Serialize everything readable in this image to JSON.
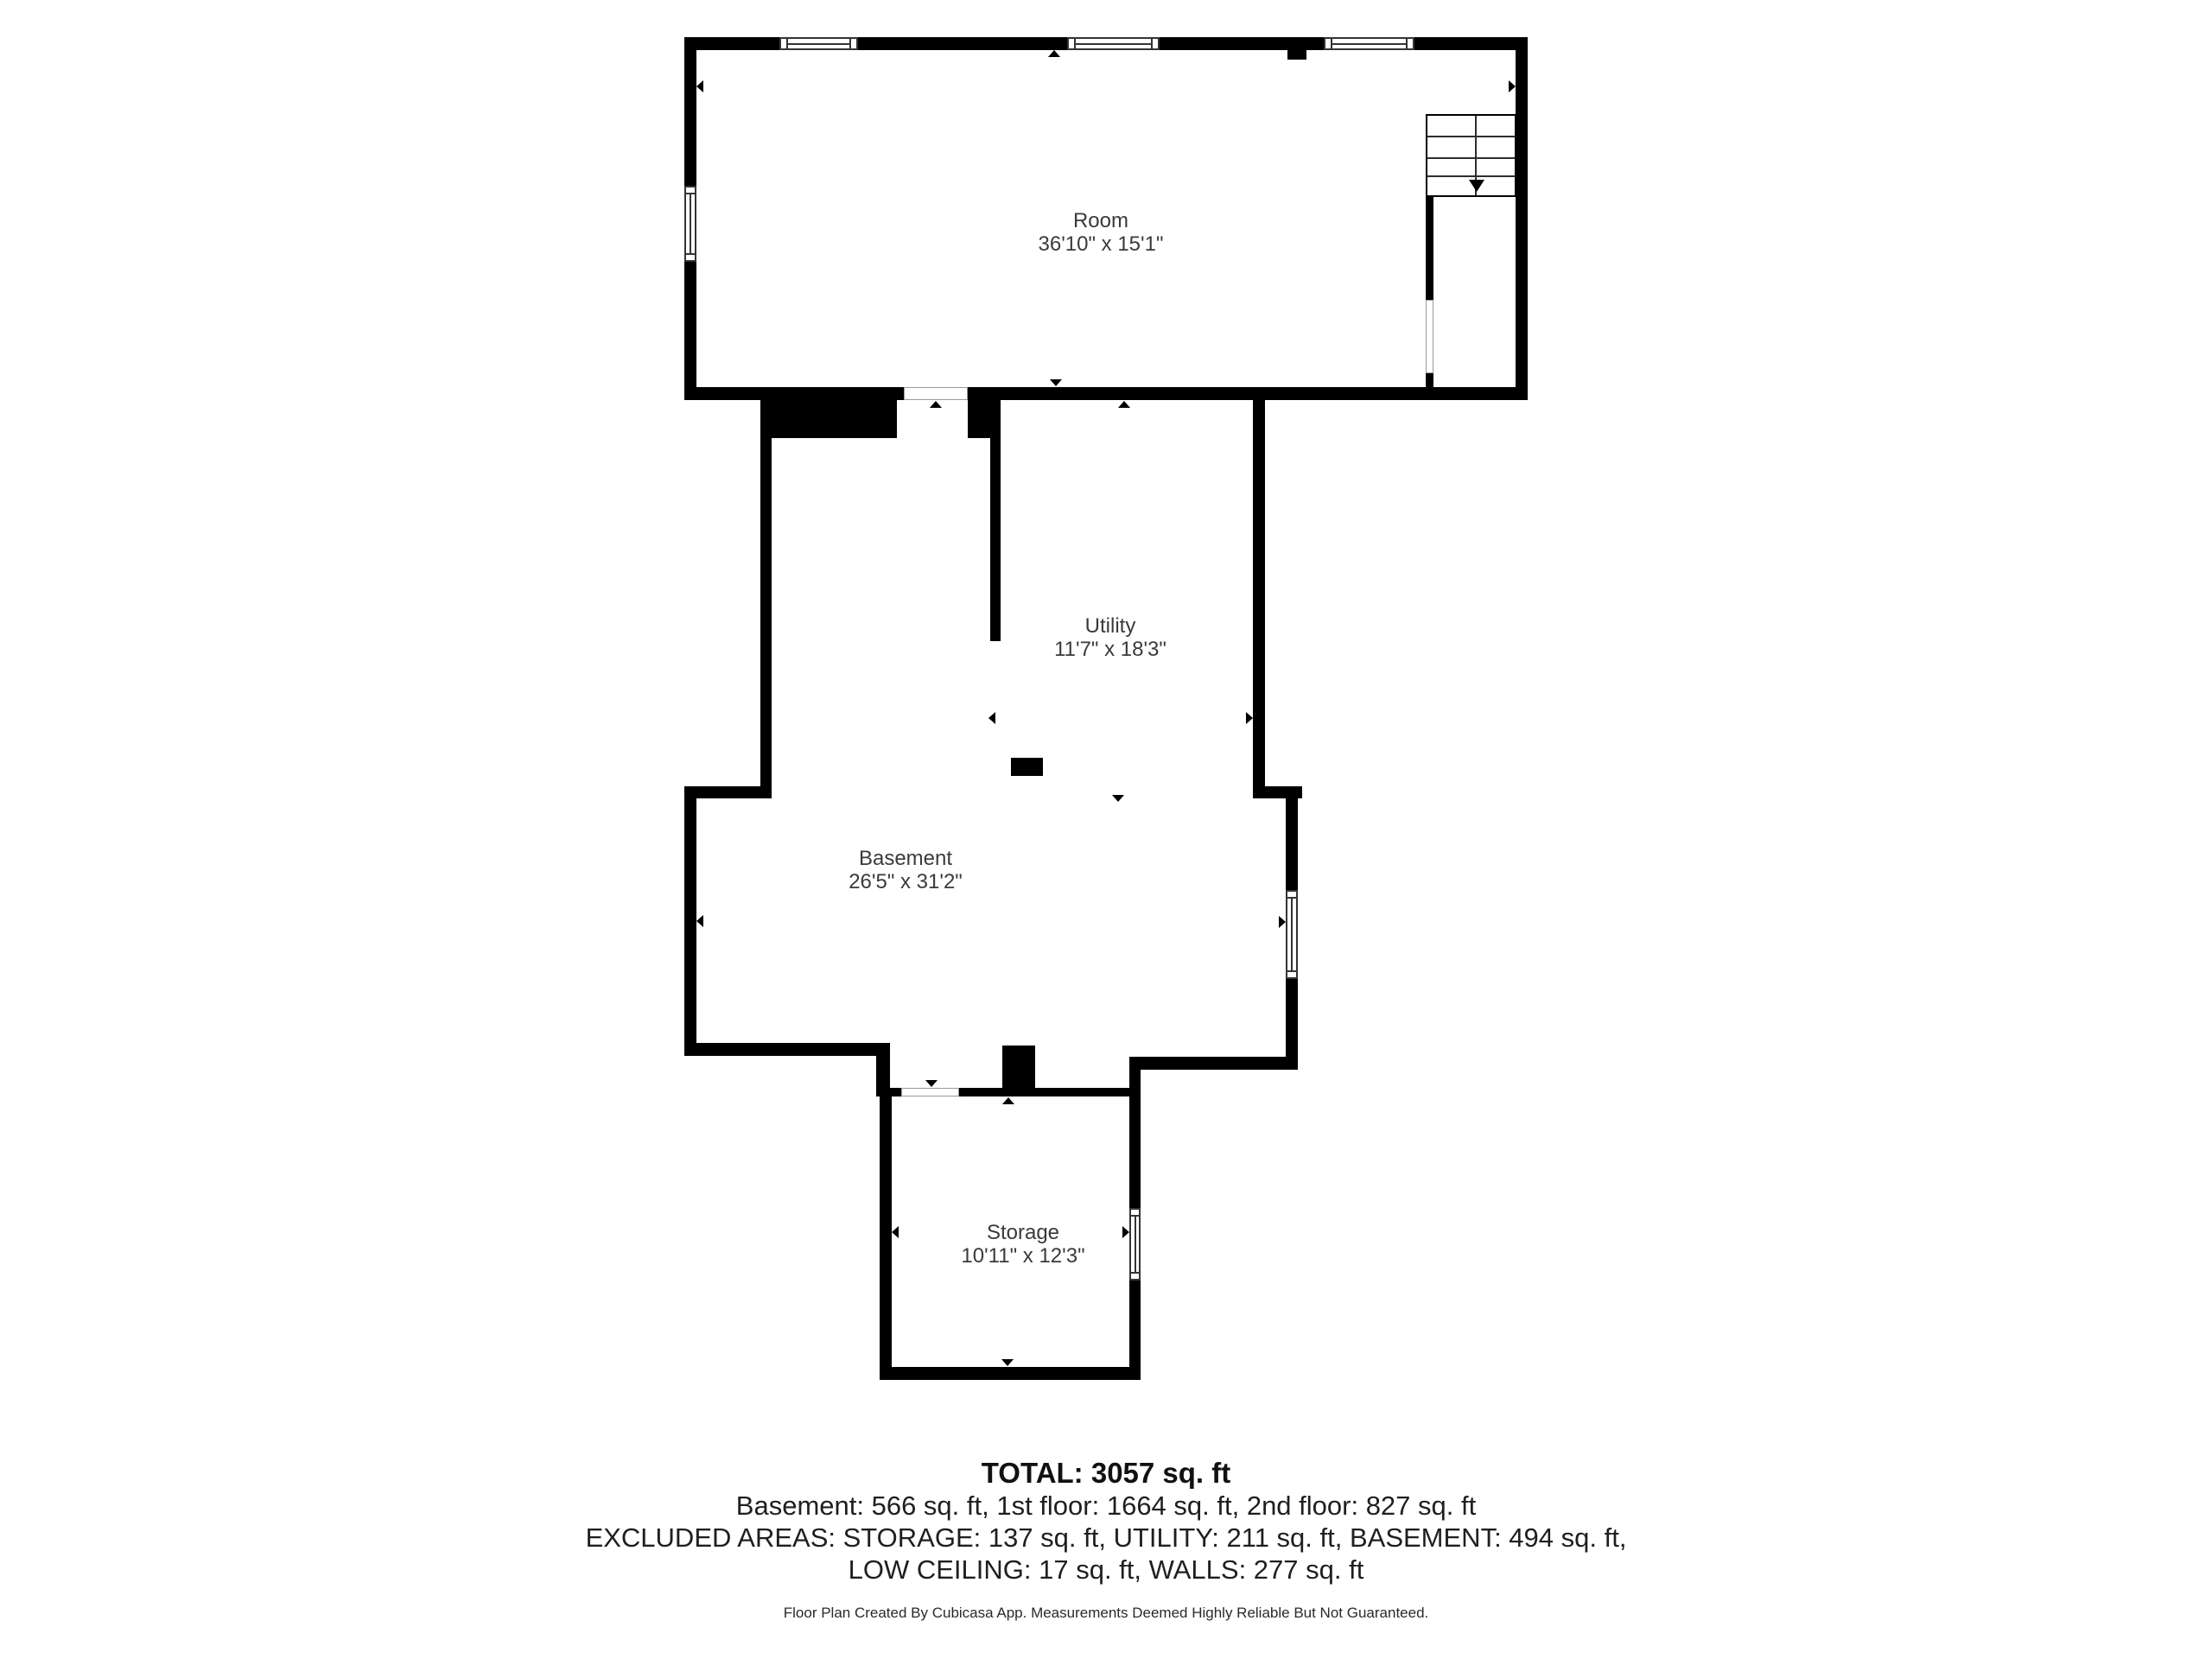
{
  "floor_plan": {
    "rooms": [
      {
        "name": "Room",
        "dimensions": "36'10\" x 15'1\""
      },
      {
        "name": "Utility",
        "dimensions": "11'7\" x 18'3\""
      },
      {
        "name": "Basement",
        "dimensions": "26'5\" x 31'2\""
      },
      {
        "name": "Storage",
        "dimensions": "10'11\" x 12'3\""
      }
    ],
    "summary": {
      "total": "TOTAL: 3057 sq. ft",
      "floors": "Basement: 566 sq. ft, 1st floor: 1664 sq. ft, 2nd floor: 827 sq. ft",
      "excluded_line1": "EXCLUDED AREAS: STORAGE: 137 sq. ft, UTILITY: 211 sq. ft, BASEMENT: 494 sq. ft,",
      "excluded_line2": "LOW CEILING: 17 sq. ft, WALLS: 277 sq. ft",
      "disclaimer": "Floor Plan Created By Cubicasa App. Measurements Deemed Highly Reliable But Not Guaranteed."
    },
    "colors": {
      "wall": "#000000",
      "text": "#3a3a3a",
      "background": "#ffffff"
    }
  }
}
